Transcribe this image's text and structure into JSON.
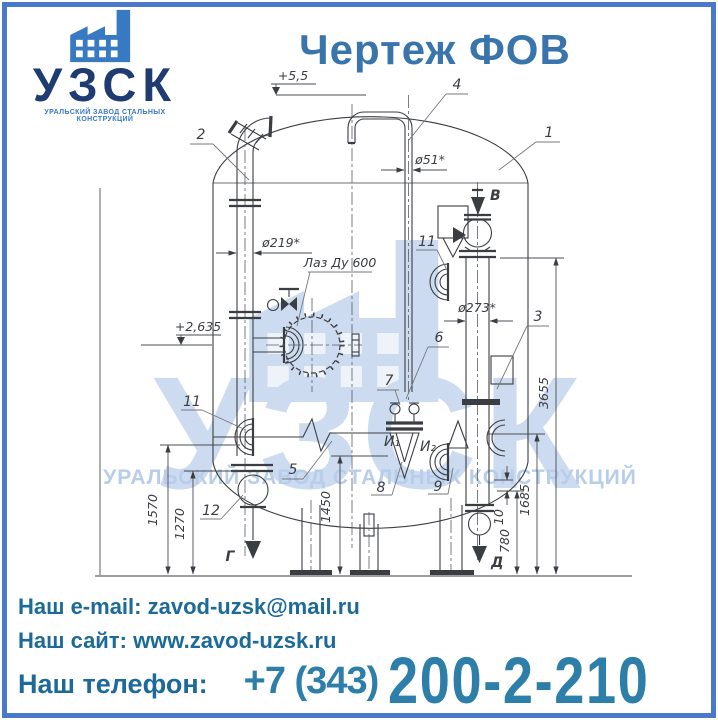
{
  "header": {
    "logo": {
      "name": "УЗСК",
      "tagline": "УРАЛЬСКИЙ ЗАВОД СТАЛЬНЫХ КОНСТРУКЦИЙ",
      "icon": "factory-icon"
    },
    "title": "Чертеж ФОВ"
  },
  "watermark": {
    "name": "УЗСК",
    "tagline": "УРАЛЬСКИЙ ЗАВОД СТАЛЬНЫХ КОНСТРУКЦИЙ",
    "icon": "factory-icon"
  },
  "drawing": {
    "manhole_label": "Лаз Ду 600",
    "elevations": {
      "top": "+5,5",
      "middle": "+2,635"
    },
    "diameters": {
      "vent": "ø51*",
      "left_pipe": "ø219*",
      "right_pipe": "ø273*"
    },
    "dimensions": {
      "d3655": "3655",
      "d1685": "1685",
      "d1570": "1570",
      "d1450": "1450",
      "d1270": "1270",
      "d780": "780",
      "d10": "10"
    },
    "items": {
      "i1": "1",
      "i2": "2",
      "i3": "3",
      "i4": "4",
      "i5": "5",
      "i6": "6",
      "i7": "7",
      "i8": "8",
      "i9": "9",
      "i11": "11",
      "i11b": "11",
      "i12": "12"
    },
    "flows": {
      "b": "В",
      "g": "Г",
      "d": "Д"
    },
    "taps": {
      "t1": "И₁",
      "t2": "И₂"
    }
  },
  "contacts": {
    "email_label": "Наш e-mail:",
    "email_value": "zavod-uzsk@mail.ru",
    "site_label": "Наш сайт:",
    "site_value": "www.zavod-uzsk.ru",
    "phone_label": "Наш телефон:",
    "phone_prefix": "+7 (343)",
    "phone_number": "200-2-210"
  },
  "colors": {
    "frame": "#4b79c9",
    "title": "#3a74ad",
    "navy": "#1e3c72",
    "blue": "#3779c2",
    "contact": "#1c6a99",
    "phone": "#2d7fa9",
    "wm": "#ccdbef",
    "wm2": "#b7cdea",
    "ink": "#3a3d42"
  }
}
